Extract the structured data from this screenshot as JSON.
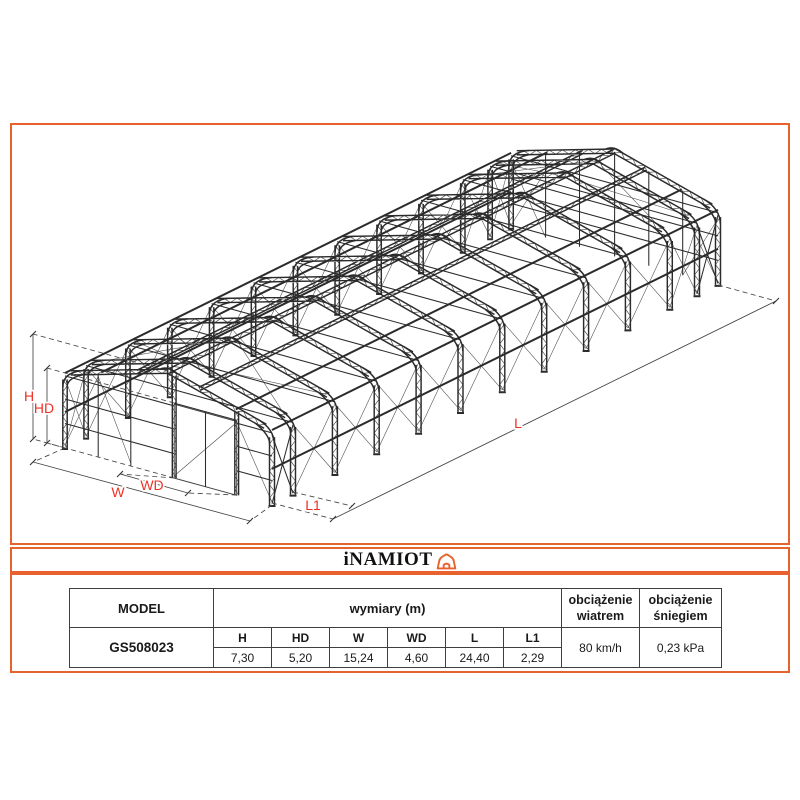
{
  "colors": {
    "accent_orange": "#E8622D",
    "structure_line": "#2b2b2b",
    "dim_label_red": "#EE3124",
    "table_border": "#3f3f3f"
  },
  "logo": {
    "text": "iNAMIOT",
    "icon": "tent-house-icon"
  },
  "drawing": {
    "dim_labels": {
      "h": "H",
      "hd": "HD",
      "w": "W",
      "wd": "WD",
      "l": "L",
      "l1": "L1"
    }
  },
  "table": {
    "model_header": "MODEL",
    "dims_header": "wymiary (m)",
    "wind_header": "obciążenie wiatrem",
    "snow_header": "obciążenie śniegiem",
    "model_value": "GS508023",
    "dim_cols": [
      "H",
      "HD",
      "W",
      "WD",
      "L",
      "L1"
    ],
    "dim_values": [
      "7,30",
      "5,20",
      "15,24",
      "4,60",
      "24,40",
      "2,29"
    ],
    "wind_value": "80 km/h",
    "snow_value": "0,23 kPa"
  }
}
